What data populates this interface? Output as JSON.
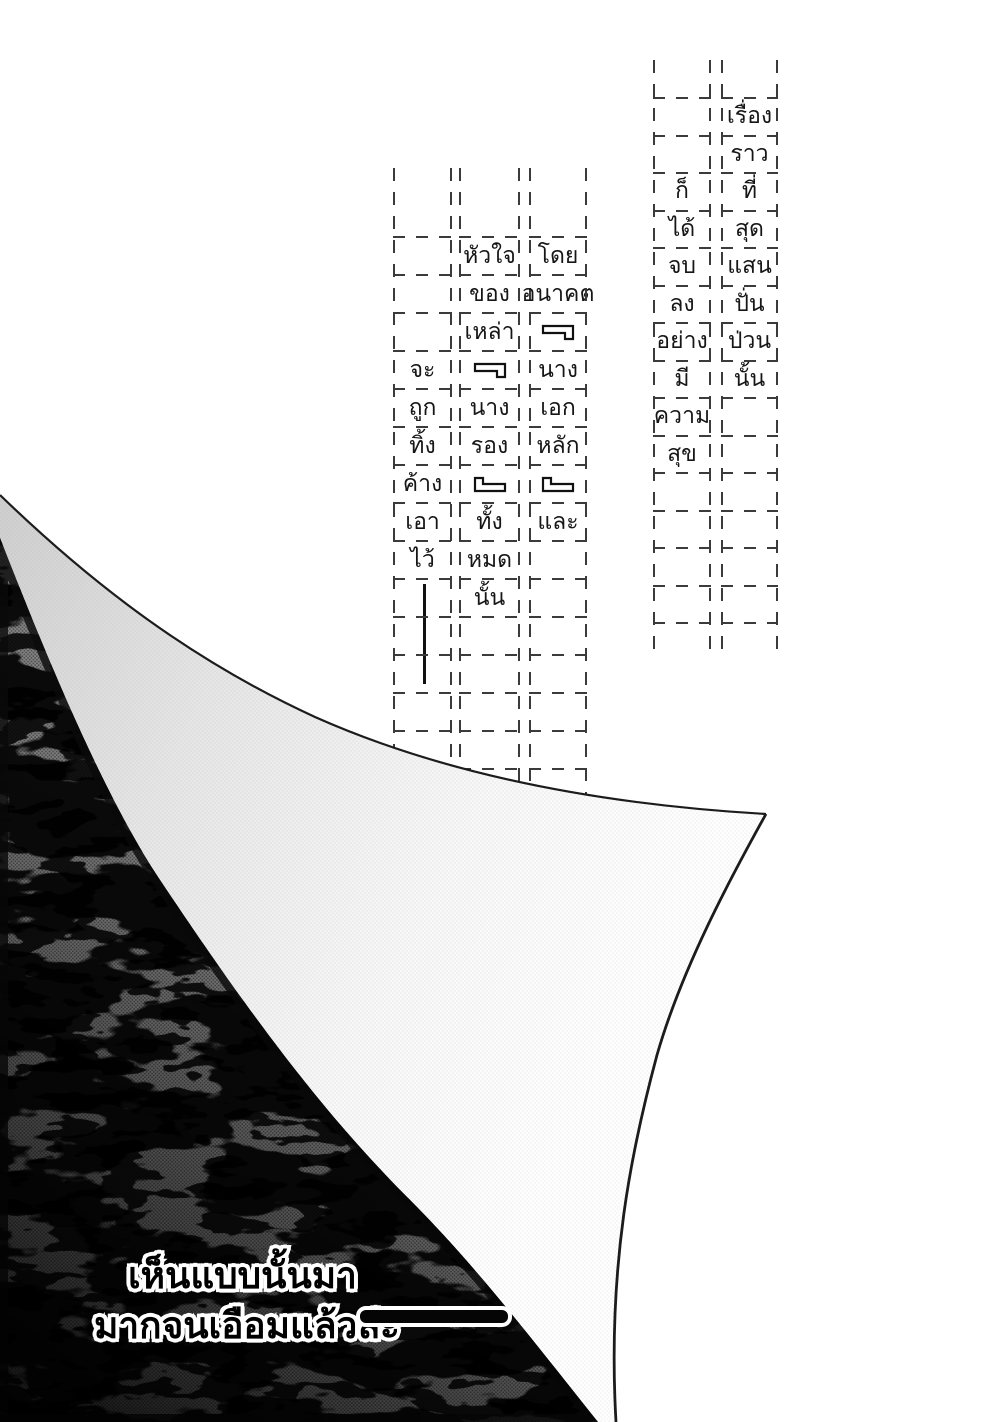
{
  "page": {
    "kind_label": "manga page with page-curl",
    "colors": {
      "page_bg": "#ffffff",
      "ink": "#111111",
      "guide_dash": "#3b3b3b",
      "tone_gray": "#a8a8a8",
      "curl_gray": "#d9d9d9"
    }
  },
  "narration_block_1": {
    "columns": [
      {
        "words": [
          "เรื่อง",
          "ราว",
          "ที่",
          "สุด",
          "แสน",
          "ปั่น",
          "ป่วน",
          "นั้น"
        ],
        "lead": 0,
        "trail": 6
      },
      {
        "words": [
          "ก็",
          "ได้",
          "จบ",
          "ลง",
          "อย่าง",
          "มี",
          "ความ",
          "สุข"
        ],
        "lead": 2,
        "trail": 4
      }
    ]
  },
  "narration_block_2": {
    "columns": [
      {
        "words": [
          "โดย",
          "อนาคต",
          "「",
          "นาง",
          "เอก",
          "หลัก",
          "」",
          "และ"
        ],
        "lead": 0,
        "trail": 6
      },
      {
        "words": [
          "หัวใจ",
          "ของ",
          "เหล่า",
          "「",
          "นาง",
          "รอง",
          "」",
          "ทั้ง",
          "หมด",
          "นั้น"
        ],
        "lead": 0,
        "trail": 4
      },
      {
        "words": [
          "จะ",
          "ถูก",
          "ทิ้ง",
          "ค้าง",
          "เอา",
          "ไว้",
          "│"
        ],
        "lead": 3,
        "trail": 4
      }
    ]
  },
  "caption": {
    "line1": "เห็นแบบนั้นมา",
    "line2": "มากจนเอือมแล้วล่ะ",
    "dash": "——"
  }
}
